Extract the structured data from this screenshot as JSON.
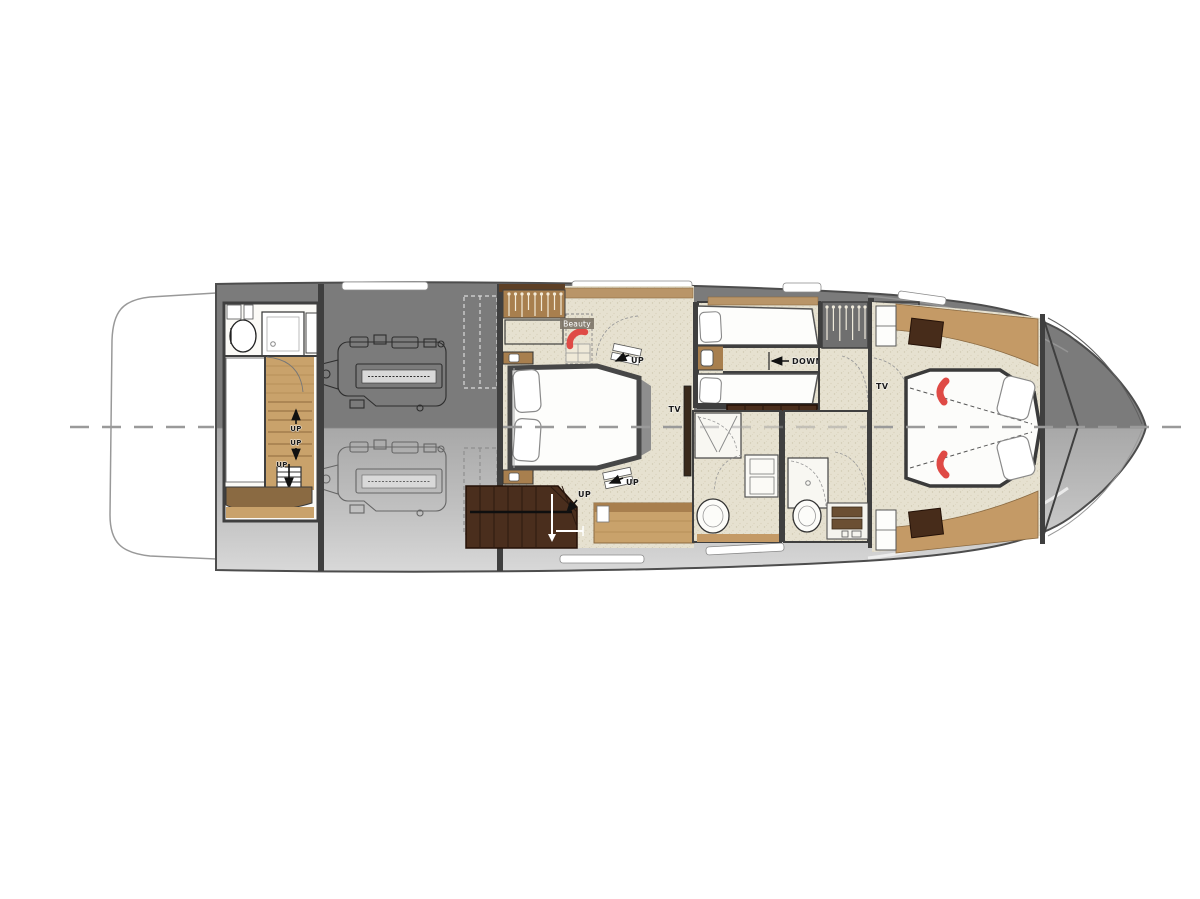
{
  "plan": {
    "name": "yacht-lower-deck-floor-plan",
    "labels": {
      "beauty": "Beauty",
      "up": "UP",
      "down": "DOWN",
      "tv": "TV"
    },
    "colors": {
      "hull_upper": "#7b7b7b",
      "hull_lower_start": "#a8a8a8",
      "hull_lower_end": "#d8d8d8",
      "wall": "#3f3f3f",
      "floor_beige": "#e6e1d0",
      "wood_light": "#c9a26b",
      "wood_mid": "#a87f4e",
      "wood_trim": "#b99568",
      "wood_dark": "#5d4026",
      "stairs_brown": "#4a2e1d",
      "accent_red": "#df4a45",
      "centerline_gray": "#9a9a9a",
      "label_text": "#1a1a1a"
    }
  }
}
